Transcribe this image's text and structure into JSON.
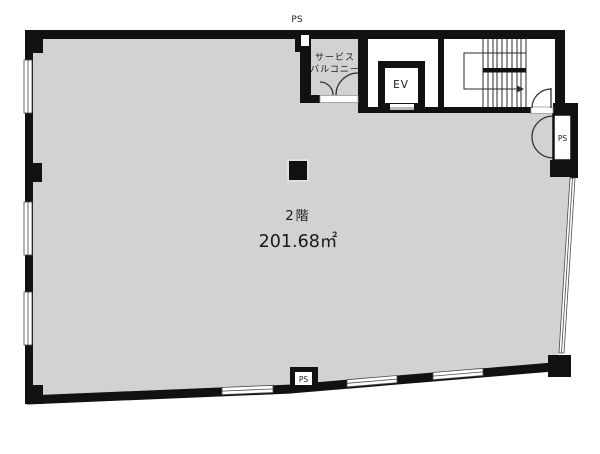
{
  "title": "2F floor plan",
  "labels": {
    "floor": "2階",
    "area": "201.68㎡",
    "service_balcony_line1": "サービス",
    "service_balcony_line2": "バルコニー",
    "elevator": "EV",
    "pipe_space_top": "PS",
    "pipe_space_right": "PS",
    "pipe_space_bottom": "PS"
  },
  "colors": {
    "wall": "#111111",
    "room_fill": "#d2d2d2",
    "line": "#2a2a2a",
    "background": "#ffffff",
    "window_fill": "#ffffff",
    "sill": "#bbbbbb"
  }
}
